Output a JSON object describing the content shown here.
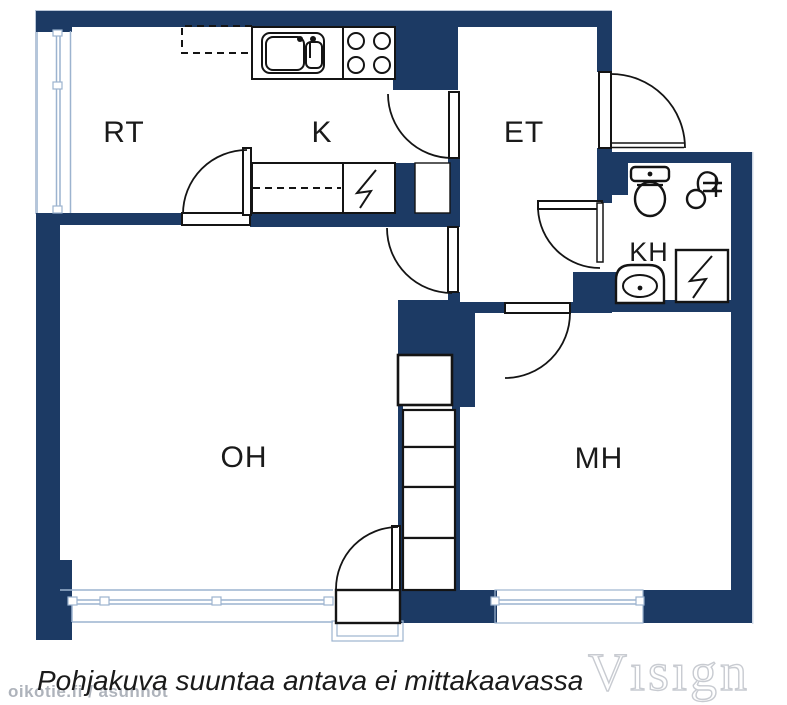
{
  "plan": {
    "title": "apartment-floor-plan",
    "rooms": {
      "rt": {
        "label": "RT"
      },
      "k": {
        "label": "K"
      },
      "et": {
        "label": "ET"
      },
      "kh": {
        "label": "KH"
      },
      "oh": {
        "label": "OH"
      },
      "mh": {
        "label": "MH"
      }
    },
    "caption": "Pohjakuva suuntaa antava ei mittakaavassa",
    "watermarks": {
      "site": "oikotie.fi / asunnot",
      "brand": "Vısıgn"
    },
    "icons": [
      "kitchen-sink-icon",
      "stove-burners-icon",
      "dishwasher-counter-icon",
      "electric-appliance-icon",
      "toilet-icon",
      "shower-icon",
      "washbasin-icon",
      "wardrobe-closet-icon",
      "door-swing-icon",
      "window-icon"
    ],
    "colors": {
      "wall": "#1c3a64",
      "line": "#141414",
      "window": "#9cb3cf",
      "text": "#1a1a1a",
      "site_watermark": "#9ba1ab",
      "brand_watermark": "#c8cbd1"
    }
  }
}
